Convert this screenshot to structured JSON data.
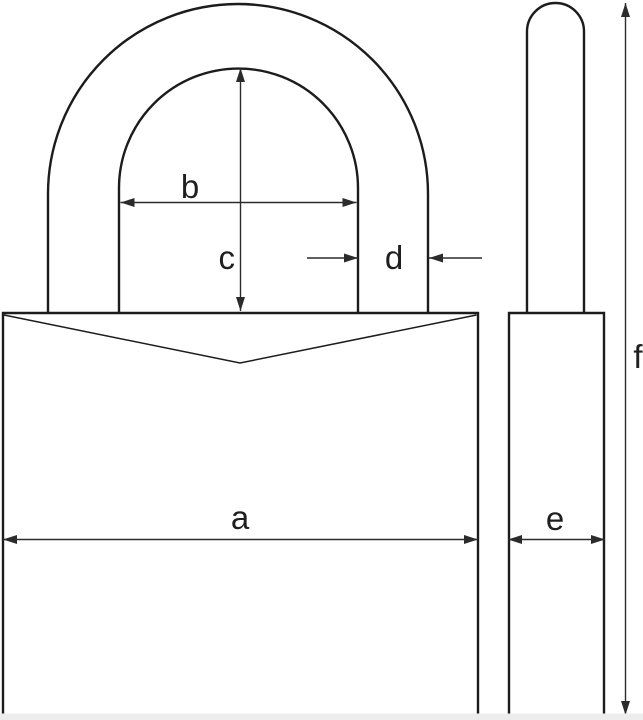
{
  "diagram": {
    "name": "padlock-dimension-diagram",
    "views": {
      "front": "padlock-front-view",
      "side": "padlock-side-view"
    },
    "labels": {
      "a": "a",
      "b": "b",
      "c": "c",
      "d": "d",
      "e": "e",
      "f": "f"
    }
  },
  "colors": {
    "background": "#ffffff",
    "outline": "#1c1c1c",
    "dimension": "#2b2b2b",
    "text": "#1f1f1f",
    "bottom_strip": "#ededed"
  }
}
